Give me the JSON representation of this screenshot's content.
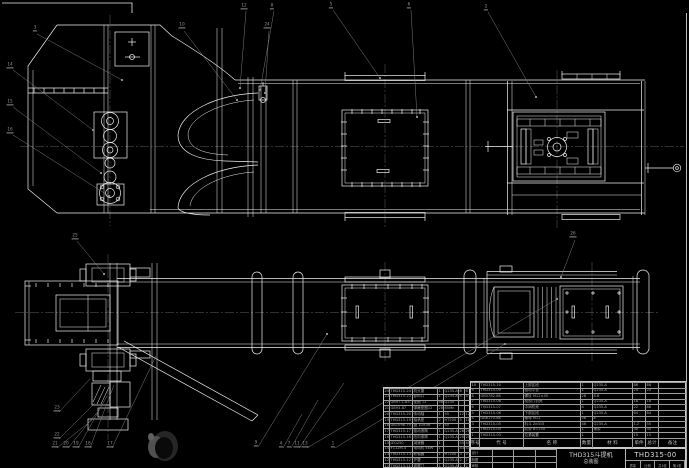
{
  "colors": {
    "background": "#000000",
    "drawing_line": "#f0f0f0",
    "annotation": "#8f8f8f",
    "table_line": "#c9c9c9",
    "table_text": "#a9a9a9"
  },
  "title_block": {
    "product": "THD315斗提机",
    "sheet_name": "总装图",
    "drawing_no": "THD315-00",
    "left_fields": [
      "设计",
      "制图",
      "审核"
    ],
    "footer_fields": [
      "质量",
      "比例",
      "共1张",
      "第1张"
    ]
  },
  "bom_right": {
    "headers": [
      "序号",
      "代  号",
      "名  称",
      "数量",
      "材  料",
      "单件",
      "总计",
      "备注"
    ],
    "rows": [
      [
        "10",
        "THD315-10",
        "上部区段",
        "1",
        "Q235-A",
        "86",
        "86",
        ""
      ],
      [
        "9",
        "THD315-09",
        "驱动平台",
        "1",
        "Q235-A",
        "24",
        "24",
        ""
      ],
      [
        "8",
        "GB5782-86",
        "螺栓 M12×45",
        "28",
        "8.8",
        "",
        "",
        ""
      ],
      [
        "7",
        "THD315-08",
        "检视门机壳",
        "1",
        "Q235-A",
        "18",
        "18",
        ""
      ],
      [
        "6",
        "THD315-07",
        "中间机壳",
        "4",
        "Q235-A",
        "22",
        "88",
        ""
      ],
      [
        "5",
        "THD315-06",
        "下部区段",
        "1",
        "Q235-A",
        "64",
        "64",
        ""
      ],
      [
        "4",
        "GB6170-86",
        "螺母 M12",
        "56",
        "8",
        "",
        "",
        ""
      ],
      [
        "3",
        "THD315-05",
        "料斗 Zd315",
        "46",
        "Q235-A",
        "1.2",
        "55",
        ""
      ],
      [
        "2",
        "THD315-04",
        "胶带 B=250",
        "1",
        "橡胶",
        "30",
        "30",
        ""
      ],
      [
        "1",
        "THD315-03",
        "拉紧装置",
        "1",
        "",
        "15",
        "15",
        ""
      ]
    ]
  },
  "bom_left": {
    "rows": [
      [
        "24",
        "THD315-24",
        "机头罩",
        "1",
        "Q235-A",
        "6",
        "6"
      ],
      [
        "23",
        "THD315-23",
        "卸料口",
        "1",
        "Q235-A",
        "4",
        "4"
      ],
      [
        "22",
        "GB97.1-85",
        "垫圈 12",
        "56",
        "Q235",
        "",
        ""
      ],
      [
        "21",
        "GB93-87",
        "弹簧垫圈12",
        "28",
        "65Mn",
        "",
        ""
      ],
      [
        "20",
        "THD315-20",
        "传动轴",
        "1",
        "45",
        "12",
        "12"
      ],
      [
        "19",
        "THD315-19",
        "轴承座",
        "2",
        "HT200",
        "5",
        "10"
      ],
      [
        "18",
        "GB1096-79",
        "键 10×56",
        "2",
        "45",
        "",
        ""
      ],
      [
        "17",
        "THD315-17",
        "驱动滚筒",
        "1",
        "Q235-A",
        "26",
        "26"
      ],
      [
        "16",
        "THD315-16",
        "改向滚筒",
        "1",
        "Q235-A",
        "20",
        "20"
      ],
      [
        "15",
        "JZQ250",
        "减速器",
        "1",
        "",
        "45",
        "45"
      ],
      [
        "14",
        "Y112M-4",
        "电动机 4kW",
        "1",
        "",
        "43",
        "43"
      ],
      [
        "13",
        "THD315-13",
        "联轴器",
        "1",
        "HT200",
        "3",
        "3"
      ],
      [
        "12",
        "THD315-12",
        "护罩",
        "1",
        "Q235-A",
        "2",
        "2"
      ],
      [
        "11",
        "THD315-11",
        "观察门",
        "1",
        "Q235-A",
        "2",
        "2"
      ]
    ]
  },
  "balloons": [
    {
      "n": "3",
      "x": 35,
      "y": 31
    },
    {
      "n": "10",
      "x": 182,
      "y": 28
    },
    {
      "n": "24",
      "x": 267,
      "y": 28
    },
    {
      "n": "12",
      "x": 244,
      "y": 9
    },
    {
      "n": "8",
      "x": 272,
      "y": 9
    },
    {
      "n": "5",
      "x": 331,
      "y": 8
    },
    {
      "n": "6",
      "x": 409,
      "y": 8
    },
    {
      "n": "2",
      "x": 486,
      "y": 10
    },
    {
      "n": "14",
      "x": 10,
      "y": 68
    },
    {
      "n": "15",
      "x": 10,
      "y": 105
    },
    {
      "n": "16",
      "x": 10,
      "y": 133
    },
    {
      "n": "25",
      "x": 75,
      "y": 239
    },
    {
      "n": "26",
      "x": 573,
      "y": 237
    },
    {
      "n": "23",
      "x": 57,
      "y": 411
    },
    {
      "n": "22",
      "x": 57,
      "y": 438
    },
    {
      "n": "21",
      "x": 55,
      "y": 447
    },
    {
      "n": "20",
      "x": 66,
      "y": 447
    },
    {
      "n": "19",
      "x": 76,
      "y": 447
    },
    {
      "n": "18",
      "x": 88,
      "y": 447
    },
    {
      "n": "17",
      "x": 110,
      "y": 447
    },
    {
      "n": "9",
      "x": 256,
      "y": 446
    },
    {
      "n": "4",
      "x": 281,
      "y": 447
    },
    {
      "n": "7",
      "x": 289,
      "y": 447
    },
    {
      "n": "11",
      "x": 297,
      "y": 447
    },
    {
      "n": "13",
      "x": 305,
      "y": 447
    },
    {
      "n": "1",
      "x": 333,
      "y": 447
    }
  ]
}
